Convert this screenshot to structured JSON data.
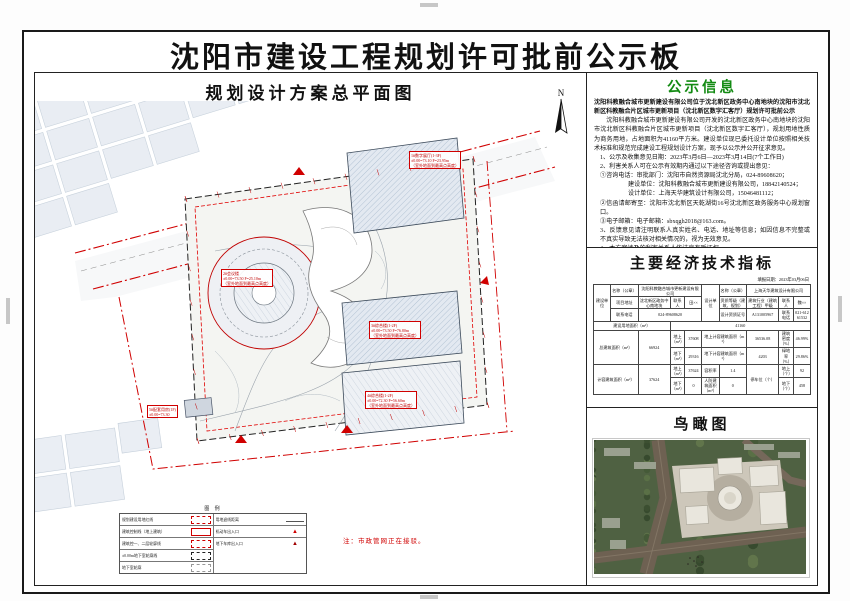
{
  "page": {
    "title": "沈阳市建设工程规划许可批前公示板"
  },
  "plan": {
    "header": "规划设计方案总平面图",
    "north_label": "N",
    "note": "注：市政管网正在接驳。",
    "legend": {
      "title": "图 例",
      "left": [
        {
          "label": "规划建设用地红线",
          "swatch": "red-dashed-bold"
        },
        {
          "label": "建筑控制线（地上建筑）",
          "swatch": "red-solid"
        },
        {
          "label": "建筑控一、二层轮廓线",
          "swatch": "red-dashed"
        },
        {
          "label": "±0.00m地下室轮廓线",
          "swatch": "black-dashed"
        },
        {
          "label": "地下室轮廓",
          "swatch": "gray-dashed"
        }
      ],
      "right": [
        {
          "label": "用地退线距离",
          "swatch": "dim-line"
        },
        {
          "label": "机动车出入口",
          "swatch": "red-triangle"
        },
        {
          "label": "地下车库出入口",
          "swatch": "red-triangle-dark"
        }
      ]
    },
    "labels": [
      {
        "x": 374,
        "y": 78,
        "l1": "1#数字展厅(1-3F)",
        "l2": "±0.00=73.10  F=23.95m",
        "l3": "（室外地面到最高点高度）"
      },
      {
        "x": 186,
        "y": 196,
        "l1": "2#会议楼",
        "l2": "±0.00=73.50  F=25.10m",
        "l3": "（室外地面到最高点高度）"
      },
      {
        "x": 334,
        "y": 248,
        "l1": "3#综合楼(1-2F)",
        "l2": "±0.00=73.50  F=76.80m",
        "l3": "（室外地面到最高点高度）"
      },
      {
        "x": 330,
        "y": 318,
        "l1": "4#综合楼(1-2F)",
        "l2": "±0.00=72.30  F=56.60m",
        "l3": "（室外地面到最高点高度）"
      },
      {
        "x": 112,
        "y": 332,
        "l1": "5#配套用房(1F)",
        "l2": "±0.00=73.30",
        "l3": ""
      }
    ]
  },
  "notice": {
    "title": "公示信息",
    "lines": {
      "l0": "沈阳科教融合城市更新建设有限公司位于沈北新区政务中心南地块的沈阳市沈北新区科教融合片区城市更新项目（沈北新区数字汇客厅）规划许可批前公示",
      "l1": "沈阳科教融合城市更新建设有限公司开发的沈北新区政务中心南地块的沈阳市沈北新区科教融合片区城市更新项目（沈北新区数字汇客厅），规划用地性质为商务用地，占地面积为41160平方米。建设单位现已委托设计单位按照相关技术标准和规范完成建设工程规划设计方案，现予以公示并公开征求意见。",
      "l2": "1、公示及收集意见日期：2023年3月6日—2023年3月14日(7个工作日)",
      "l3": "2、利害关系人可在公示有效期内通过以下途径咨询或提出意见：",
      "l4": "①咨询电话：审批部门：沈阳市自然资源局沈北分局，024-89608620；",
      "l5": "建设单位：沈阳科教融合城市更新建设有限公司，18842140524；",
      "l6": "设计单位：上海天华建筑设计有限公司，15046481112；",
      "l7": "②信函请邮寄至：沈阳市沈北新区天乾湖街16号沈北新区政务服务中心规划窗口。",
      "l8": "③电子邮箱：电子邮箱：sbxqgh2018@163.com。",
      "l9": "3、反馈意见请注明联系人真实姓名、电话、地址等信息；如因信息不完整或不真实导致无法核对相关情况的，视为无效意见。",
      "l10": "4、本方案涉及的利害关系人依法享有听证权。"
    },
    "sign_org": "沈阳市自然资源局沈北分局",
    "sign_date": "2023年3月6日"
  },
  "econ": {
    "header": "主要经济技术指标",
    "fill_date": "填报日期：2023年03月06日",
    "table": {
      "col_widths": [
        16,
        26,
        30,
        14,
        16,
        16,
        26,
        30,
        14,
        16
      ],
      "rows": [
        [
          {
            "t": "建设单位",
            "rs": 3
          },
          {
            "t": "名称（公章）"
          },
          {
            "t": "沈阳科教融合城市更新建设有限公司",
            "cs": 3
          },
          {
            "t": "设计单位",
            "rs": 3
          },
          {
            "t": "名称（公章）"
          },
          {
            "t": "上海天华建筑设计有限公司",
            "cs": 3
          }
        ],
        [
          {
            "t": "项目地址"
          },
          {
            "t": "沈北新区政务中心南地块"
          },
          {
            "t": "联系人"
          },
          {
            "t": "田××"
          },
          {
            "t": "资质等级（建筑、规划）"
          },
          {
            "t": "建筑行业（建筑工程）甲级"
          },
          {
            "t": "联系人"
          },
          {
            "t": "魏××"
          }
        ],
        [
          {
            "t": "联系电话"
          },
          {
            "t": "024-89608620",
            "cs": 3
          },
          {
            "t": "设计资质证号"
          },
          {
            "t": "A131005967"
          },
          {
            "t": "联系电话"
          },
          {
            "t": "021-61261532"
          }
        ],
        [
          {
            "t": "建设用地面积（m²）",
            "cs": 3
          },
          {
            "t": "41160",
            "cs": 7
          }
        ],
        [
          {
            "t": "总建筑面积（m²）",
            "cs": 2,
            "rs": 2
          },
          {
            "t": "66924",
            "rs": 2
          },
          {
            "t": "地上（m²）"
          },
          {
            "t": "37608"
          },
          {
            "t": "地上计容建筑面积（m²）",
            "cs": 2
          },
          {
            "t": "36536.08"
          },
          {
            "t": "建筑密度（%）"
          },
          {
            "t": "46.99%"
          }
        ],
        [
          {
            "t": "地下（m²）"
          },
          {
            "t": "29316"
          },
          {
            "t": "地下计容建筑面积（m²）",
            "cs": 2
          },
          {
            "t": "4203"
          },
          {
            "t": "绿地率（%）"
          },
          {
            "t": "29.86%"
          }
        ],
        [
          {
            "t": "计容建筑面积（m²）",
            "cs": 2,
            "rs": 2
          },
          {
            "t": "37624",
            "rs": 2
          },
          {
            "t": "地上（m²）"
          },
          {
            "t": "37624"
          },
          {
            "t": "容积率"
          },
          {
            "t": "1.4"
          },
          {
            "t": "停车位（个）",
            "rs": 2
          },
          {
            "t": "地上（个）"
          },
          {
            "t": "92"
          }
        ],
        [
          {
            "t": "地下（m²）"
          },
          {
            "t": "0"
          },
          {
            "t": "人防建筑面积（m²）"
          },
          {
            "t": "0"
          },
          {
            "t": "地下（个）"
          },
          {
            "t": "458"
          }
        ]
      ]
    }
  },
  "aerial": {
    "header": "鸟瞰图"
  },
  "colors": {
    "notice_green": "#128a12",
    "red_line": "#d00000",
    "parcel_fill": "#e8edf3",
    "tree_green": "#4f6142"
  }
}
